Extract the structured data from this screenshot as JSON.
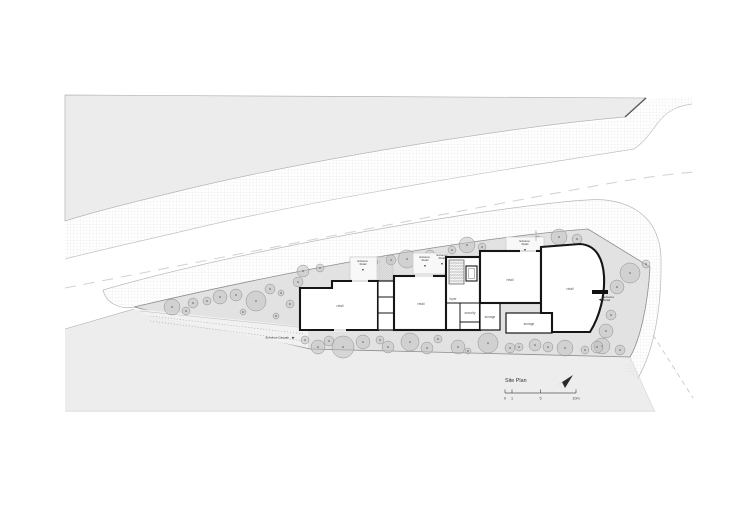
{
  "colors": {
    "wall": "#161616",
    "parcel_gray": "#ececec",
    "site_gray": "#e2e2e2",
    "driveway_gray": "#f1f1f1",
    "tree_gray": "#c0c0c0",
    "hatch_line": "#dcdcdc",
    "boundary_line": "#8c8c8c",
    "text": "#444444"
  },
  "plan": {
    "title": "Site Plan",
    "north_arrow_icon": "north-arrow",
    "grid_marker": "1",
    "scale": {
      "t0": "0",
      "t1": "1",
      "t5": "5",
      "t10": "10m"
    },
    "rooms": {
      "retail_a": "retail",
      "retail_b": "retail",
      "retail_c": "retail",
      "retail_d": "retail",
      "foyer": "foyer",
      "security": "security",
      "storage_a": "storage",
      "storage_b": "storage"
    },
    "entrances": {
      "word_entrance": "Entrance",
      "word_retail": "Retail",
      "carpark": "Entrance Carpark"
    },
    "icons": {
      "down_arrow": "▼",
      "right_arrow": "▶",
      "left_arrow": "◀"
    }
  },
  "trees": [
    [
      172,
      307,
      8
    ],
    [
      186,
      311,
      4
    ],
    [
      193,
      303,
      5
    ],
    [
      207,
      301,
      4
    ],
    [
      220,
      297,
      7
    ],
    [
      236,
      295,
      6
    ],
    [
      243,
      312,
      3
    ],
    [
      256,
      301,
      10
    ],
    [
      270,
      289,
      5
    ],
    [
      281,
      293,
      3
    ],
    [
      290,
      304,
      4
    ],
    [
      298,
      282,
      5
    ],
    [
      276,
      316,
      3
    ],
    [
      303,
      271,
      6
    ],
    [
      320,
      268,
      4
    ],
    [
      356,
      264,
      6
    ],
    [
      374,
      262,
      4
    ],
    [
      391,
      260,
      5
    ],
    [
      407,
      259,
      9
    ],
    [
      430,
      255,
      5
    ],
    [
      452,
      250,
      4
    ],
    [
      467,
      245,
      8
    ],
    [
      482,
      247,
      4
    ],
    [
      517,
      243,
      6
    ],
    [
      538,
      240,
      4
    ],
    [
      559,
      237,
      8
    ],
    [
      577,
      239,
      5
    ],
    [
      630,
      273,
      10
    ],
    [
      646,
      264,
      4
    ],
    [
      617,
      287,
      7
    ],
    [
      611,
      315,
      5
    ],
    [
      606,
      331,
      7
    ],
    [
      602,
      346,
      8
    ],
    [
      620,
      350,
      5
    ],
    [
      305,
      340,
      4
    ],
    [
      318,
      347,
      7
    ],
    [
      329,
      341,
      5
    ],
    [
      343,
      347,
      11
    ],
    [
      363,
      342,
      7
    ],
    [
      380,
      340,
      4
    ],
    [
      388,
      347,
      6
    ],
    [
      410,
      342,
      9
    ],
    [
      427,
      348,
      6
    ],
    [
      438,
      339,
      4
    ],
    [
      458,
      347,
      7
    ],
    [
      468,
      351,
      3
    ],
    [
      488,
      343,
      10
    ],
    [
      510,
      348,
      5
    ],
    [
      519,
      347,
      4
    ],
    [
      535,
      345,
      6
    ],
    [
      548,
      347,
      5
    ],
    [
      565,
      348,
      8
    ],
    [
      585,
      350,
      4
    ],
    [
      597,
      347,
      6
    ]
  ]
}
